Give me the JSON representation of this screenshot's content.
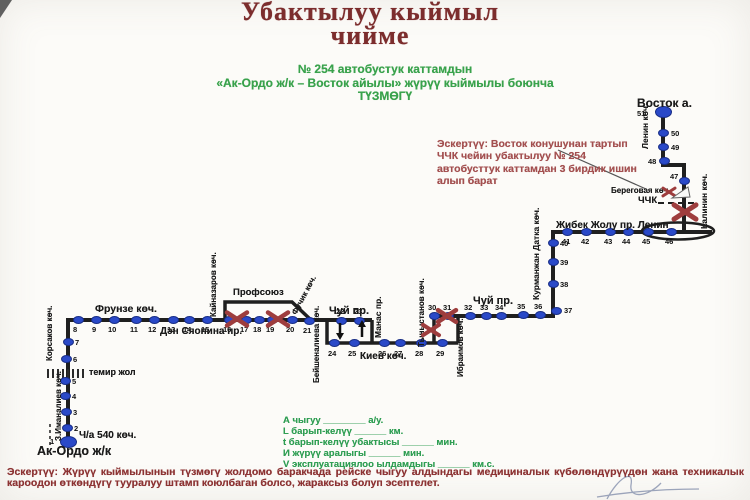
{
  "title": {
    "line1": "Убактылуу кыймыл",
    "line2": "чийме"
  },
  "subtitle": {
    "line1": "№ 254  автобустук каттамдын",
    "line2": "«Ак-Ордо ж/к – Восток айылы» жүрүү кыймылы боюнча",
    "line3": "ТҮЗМӨГҮ"
  },
  "note_right": {
    "text": "Эскертүү: Восток конушунан тартып ЧЧК чейин убактылуу № 254 автобусттук каттамдан 3 бирдик ишин алып барат"
  },
  "legend": {
    "lines": [
      "А чыгуу ________ а/у.",
      "L барып-келүү ______ км.",
      "t барып-келүү убактысы ______ мин.",
      "И жүрүү аралыгы ______ мин.",
      "V эксплуатациялоо ылдамдыгы ______ км.с."
    ]
  },
  "note_bottom": {
    "label": "Эскертүү:",
    "text": " Жүрүү кыймылынын түзмөгү жолдомо баракчада рейске чыгуу алдындагы медициналык күбөлөндүрүүдөн жана техникалык кароодон өткөндүгү тууралуу штамп коюлбаган болсо, жараксыз болуп эсептелет."
  },
  "colors": {
    "title_maroon": "#7c2d2d",
    "green": "#39a24c",
    "note_red": "#a35050",
    "route_black": "#1f1f1f",
    "stop_blue": "#2a49c8",
    "closure_red": "#9e3d3d"
  },
  "diagram": {
    "stops": [
      {
        "n": 1,
        "x": 68,
        "y": 442,
        "lx": 50,
        "ly": 437,
        "big": true
      },
      {
        "n": 2,
        "x": 67,
        "y": 428,
        "lx": 74,
        "ly": 424
      },
      {
        "n": 3,
        "x": 66,
        "y": 412,
        "lx": 73,
        "ly": 408
      },
      {
        "n": 4,
        "x": 65,
        "y": 396,
        "lx": 72,
        "ly": 392
      },
      {
        "n": 5,
        "x": 65,
        "y": 381,
        "lx": 72,
        "ly": 377
      },
      {
        "n": 6,
        "x": 66,
        "y": 359,
        "lx": 73,
        "ly": 355
      },
      {
        "n": 7,
        "x": 68,
        "y": 342,
        "lx": 75,
        "ly": 338
      },
      {
        "n": 8,
        "x": 78,
        "y": 320,
        "lx": 73,
        "ly": 325
      },
      {
        "n": 9,
        "x": 96,
        "y": 320,
        "lx": 92,
        "ly": 325
      },
      {
        "n": 10,
        "x": 114,
        "y": 320,
        "lx": 108,
        "ly": 325
      },
      {
        "n": 11,
        "x": 136,
        "y": 320,
        "lx": 130,
        "ly": 325
      },
      {
        "n": 12,
        "x": 154,
        "y": 320,
        "lx": 148,
        "ly": 325
      },
      {
        "n": 13,
        "x": 173,
        "y": 320,
        "lx": 167,
        "ly": 325
      },
      {
        "n": 14,
        "x": 189,
        "y": 320,
        "lx": 183,
        "ly": 325
      },
      {
        "n": 15,
        "x": 207,
        "y": 320,
        "lx": 201,
        "ly": 325
      },
      {
        "n": 16,
        "x": 229,
        "y": 320,
        "lx": 223,
        "ly": 325
      },
      {
        "n": 17,
        "x": 246,
        "y": 320,
        "lx": 240,
        "ly": 325
      },
      {
        "n": 18,
        "x": 259,
        "y": 320,
        "lx": 253,
        "ly": 325
      },
      {
        "n": 19,
        "x": 272,
        "y": 320,
        "lx": 266,
        "ly": 325
      },
      {
        "n": 20,
        "x": 292,
        "y": 320,
        "lx": 286,
        "ly": 325
      },
      {
        "n": 21,
        "x": 309,
        "y": 321,
        "lx": 303,
        "ly": 326
      },
      {
        "n": 22,
        "x": 341,
        "y": 321,
        "lx": 336,
        "ly": 307
      },
      {
        "n": 23,
        "x": 359,
        "y": 321,
        "lx": 354,
        "ly": 307
      },
      {
        "n": 24,
        "x": 334,
        "y": 343,
        "lx": 328,
        "ly": 349
      },
      {
        "n": 25,
        "x": 354,
        "y": 343,
        "lx": 348,
        "ly": 349
      },
      {
        "n": 26,
        "x": 384,
        "y": 343,
        "lx": 378,
        "ly": 349
      },
      {
        "n": 27,
        "x": 400,
        "y": 343,
        "lx": 394,
        "ly": 349
      },
      {
        "n": 28,
        "x": 421,
        "y": 343,
        "lx": 415,
        "ly": 349
      },
      {
        "n": 29,
        "x": 442,
        "y": 343,
        "lx": 436,
        "ly": 349
      },
      {
        "n": 30,
        "x": 434,
        "y": 316,
        "lx": 428,
        "ly": 303
      },
      {
        "n": 31,
        "x": 448,
        "y": 316,
        "lx": 443,
        "ly": 303
      },
      {
        "n": 32,
        "x": 470,
        "y": 316,
        "lx": 464,
        "ly": 303
      },
      {
        "n": 33,
        "x": 486,
        "y": 316,
        "lx": 480,
        "ly": 303
      },
      {
        "n": 34,
        "x": 501,
        "y": 316,
        "lx": 495,
        "ly": 303
      },
      {
        "n": 35,
        "x": 523,
        "y": 315,
        "lx": 517,
        "ly": 302
      },
      {
        "n": 36,
        "x": 540,
        "y": 315,
        "lx": 534,
        "ly": 302
      },
      {
        "n": 37,
        "x": 556,
        "y": 311,
        "lx": 564,
        "ly": 306
      },
      {
        "n": 38,
        "x": 553,
        "y": 284,
        "lx": 560,
        "ly": 280
      },
      {
        "n": 39,
        "x": 553,
        "y": 262,
        "lx": 560,
        "ly": 258
      },
      {
        "n": 40,
        "x": 553,
        "y": 243,
        "lx": 560,
        "ly": 239
      },
      {
        "n": 41,
        "x": 567,
        "y": 232,
        "lx": 562,
        "ly": 237
      },
      {
        "n": 42,
        "x": 586,
        "y": 232,
        "lx": 581,
        "ly": 237
      },
      {
        "n": 43,
        "x": 610,
        "y": 232,
        "lx": 604,
        "ly": 237
      },
      {
        "n": 44,
        "x": 628,
        "y": 232,
        "lx": 622,
        "ly": 237
      },
      {
        "n": 45,
        "x": 648,
        "y": 232,
        "lx": 642,
        "ly": 237
      },
      {
        "n": 46,
        "x": 671,
        "y": 232,
        "lx": 665,
        "ly": 237
      },
      {
        "n": 47,
        "x": 684,
        "y": 181,
        "lx": 670,
        "ly": 172
      },
      {
        "n": 48,
        "x": 664,
        "y": 161,
        "lx": 648,
        "ly": 157
      },
      {
        "n": 49,
        "x": 663,
        "y": 147,
        "lx": 671,
        "ly": 143
      },
      {
        "n": 50,
        "x": 663,
        "y": 133,
        "lx": 671,
        "ly": 129
      },
      {
        "n": 51,
        "x": 663,
        "y": 112,
        "lx": 637,
        "ly": 109,
        "big": true
      }
    ],
    "streets": [
      {
        "text": "Восток а.",
        "x": 637,
        "y": 96,
        "size": 12
      },
      {
        "text": "Ленин көч.",
        "x": 640,
        "y": 149,
        "rot": -90,
        "size": 8.5
      },
      {
        "text": "Береговая көч.",
        "x": 611,
        "y": 186,
        "size": 8
      },
      {
        "text": "ЧЧК",
        "x": 638,
        "y": 195,
        "size": 9.5
      },
      {
        "text": "Калинин көч.",
        "x": 699,
        "y": 229,
        "rot": -90,
        "size": 8.5
      },
      {
        "text": "Жибек Жолу пр.   Ленин",
        "x": 556,
        "y": 220,
        "size": 10
      },
      {
        "text": "Курманжан Датка көч.",
        "x": 531,
        "y": 300,
        "rot": -90,
        "size": 8.5
      },
      {
        "text": "Чуй пр.",
        "x": 473,
        "y": 295,
        "size": 11
      },
      {
        "text": "Тыныстанов көч.",
        "x": 417,
        "y": 347,
        "rot": -90,
        "size": 8
      },
      {
        "text": "Ибраимов көч.",
        "x": 456,
        "y": 377,
        "rot": -90,
        "size": 8
      },
      {
        "text": "Чуй пр.",
        "x": 329,
        "y": 305,
        "size": 11
      },
      {
        "text": "Манас пр.",
        "x": 373,
        "y": 338,
        "rot": -90,
        "size": 8.5
      },
      {
        "text": "Киев көч.",
        "x": 360,
        "y": 351,
        "size": 10
      },
      {
        "text": "Бейшеналиева көч.",
        "x": 312,
        "y": 383,
        "rot": -90,
        "size": 8
      },
      {
        "text": "Фучик көч.",
        "x": 290,
        "y": 312,
        "rot": -62,
        "size": 8
      },
      {
        "text": "Профсоюз",
        "x": 233,
        "y": 287,
        "size": 9.5
      },
      {
        "text": "Кайназаров көч.",
        "x": 209,
        "y": 317,
        "rot": -90,
        "size": 8
      },
      {
        "text": "Дэн Сяопина пр.",
        "x": 160,
        "y": 326,
        "size": 10
      },
      {
        "text": "Фрунзе көч.",
        "x": 95,
        "y": 303,
        "size": 10.5
      },
      {
        "text": "темир жол",
        "x": 89,
        "y": 367,
        "size": 9
      },
      {
        "text": "Корсаков көч.",
        "x": 45,
        "y": 361,
        "rot": -90,
        "size": 8
      },
      {
        "text": "З.Иманалиев көч.",
        "x": 54,
        "y": 441,
        "rot": -90,
        "size": 8
      },
      {
        "text": "Ч/а 540 көч.",
        "x": 79,
        "y": 430,
        "size": 10
      },
      {
        "text": "Ак-Ордо ж/к",
        "x": 37,
        "y": 444,
        "size": 12.5
      }
    ],
    "closures": [
      {
        "x": 237,
        "y": 319,
        "s": 10,
        "w": 4.5
      },
      {
        "x": 278,
        "y": 319,
        "s": 10,
        "w": 4.5
      },
      {
        "x": 447,
        "y": 316,
        "s": 9,
        "w": 4.5
      },
      {
        "x": 431,
        "y": 330,
        "s": 8,
        "w": 4
      },
      {
        "x": 685,
        "y": 212,
        "s": 11,
        "w": 5
      },
      {
        "x": 669,
        "y": 192,
        "s": 6,
        "w": 3
      }
    ]
  }
}
